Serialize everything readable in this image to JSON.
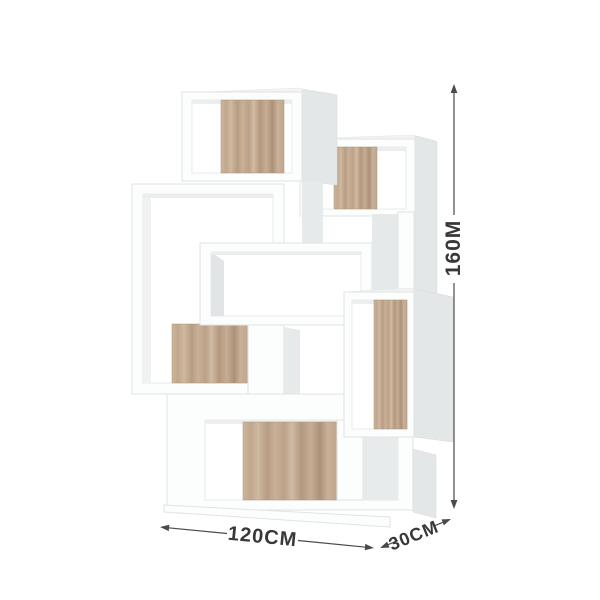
{
  "diagram": {
    "background": "#ffffff",
    "palette": {
      "frame_white": "#fcfdfd",
      "edge_gray": "#e1e4e4",
      "side_gray": "#e4e7e7",
      "top_gray": "#f2f3f3",
      "inner_shadow": "#eceeee",
      "oak_light": "#d1bba4",
      "oak_mid": "#c2a98f",
      "oak_dark": "#ab9178",
      "dim_line": "#4a4a4a",
      "dim_text": "#383838"
    },
    "dimensions": {
      "height": {
        "label": "160M"
      },
      "width": {
        "label": "120CM"
      },
      "depth": {
        "label": "30CM"
      }
    }
  }
}
